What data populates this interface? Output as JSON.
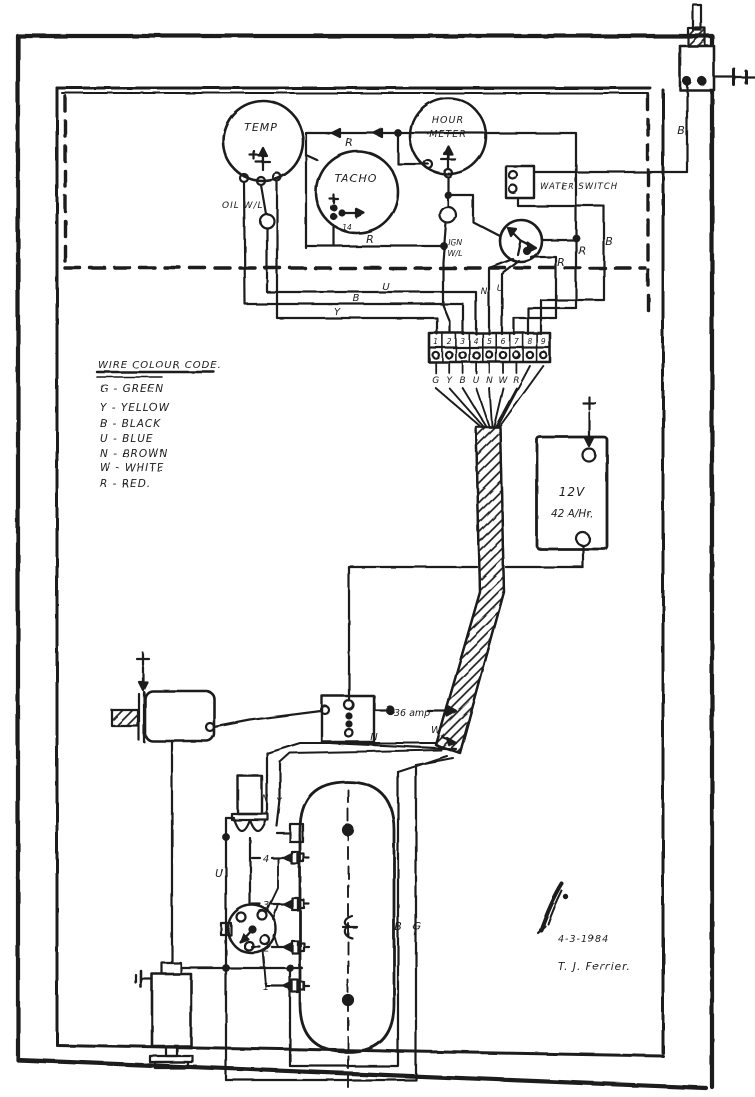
{
  "ink": "#1c1c1c",
  "paper": "#ffffff",
  "gauges": {
    "temp": "TEMP",
    "tacho": "TACHO",
    "hour_meter_line1": "HOUR",
    "hour_meter_line2": "METER",
    "tacho_terminal": "14"
  },
  "lamps": {
    "oil": "OIL W/L",
    "ign_line1": "IGN",
    "ign_line2": "W/L"
  },
  "switches": {
    "water": "WATER SWITCH"
  },
  "wire_labels": {
    "r_feed": "R",
    "r_tacho": "R",
    "u_bus": "U",
    "b_bus": "B",
    "y_bus": "Y",
    "n_strip": "N",
    "u_strip": "U",
    "r_switch_1": "R",
    "r_switch_2": "R",
    "b_switch": "B",
    "b_master": "B",
    "n_box": "N",
    "w_box": "W",
    "n_coil": "N",
    "y_coil": "Y",
    "u_dist": "U",
    "b_engine": "B",
    "g_engine": "G"
  },
  "legend": {
    "title": "WIRE COLOUR CODE.",
    "items": [
      "G - GREEN",
      "Y - YELLOW",
      "B - BLACK",
      "U - BLUE",
      "N - BROWN",
      "W - WHITE",
      "R - RED."
    ]
  },
  "battery": {
    "line1": "12V",
    "line2": "42 A/Hr."
  },
  "terminal_strip": {
    "numbers": [
      "1",
      "2",
      "3",
      "4",
      "5",
      "6",
      "7",
      "8",
      "9"
    ],
    "wires": [
      "G",
      "Y",
      "B",
      "U",
      "N",
      "W",
      "R"
    ]
  },
  "ammeter": {
    "label": "36 amp"
  },
  "plugs": {
    "numbers": [
      "4",
      "3",
      "2",
      "1"
    ]
  },
  "signature": {
    "date": "4-3-1984",
    "name": "T. J. Ferrier."
  }
}
